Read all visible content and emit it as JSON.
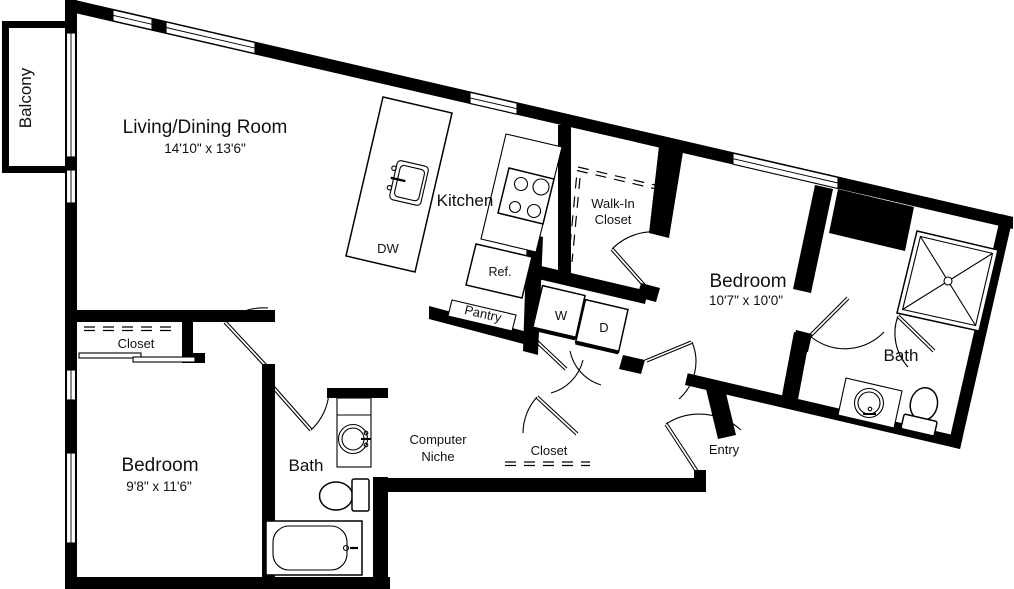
{
  "floorplan": {
    "background": "#ffffff",
    "wall_color": "#000000",
    "text_color": "#111111",
    "rooms": {
      "balcony": {
        "label": "Balcony"
      },
      "living_dining": {
        "label": "Living/Dining Room",
        "dims": "14'10\" x 13'6\""
      },
      "kitchen": {
        "label": "Kitchen"
      },
      "walk_in_closet": {
        "line1": "Walk-In",
        "line2": "Closet"
      },
      "bedroom_right": {
        "label": "Bedroom",
        "dims": "10'7\" x 10'0\""
      },
      "bath_right": {
        "label": "Bath"
      },
      "bedroom_left": {
        "label": "Bedroom",
        "dims": "9'8\" x 11'6\""
      },
      "bath_left": {
        "label": "Bath"
      },
      "computer_niche": {
        "line1": "Computer",
        "line2": "Niche"
      },
      "bedroom_closet": {
        "label": "Closet"
      },
      "hall_closet": {
        "label": "Closet"
      },
      "entry": {
        "label": "Entry"
      }
    },
    "appliances": {
      "dishwasher": "DW",
      "refrigerator": "Ref.",
      "pantry": "Pantry",
      "washer": "W",
      "dryer": "D"
    }
  }
}
